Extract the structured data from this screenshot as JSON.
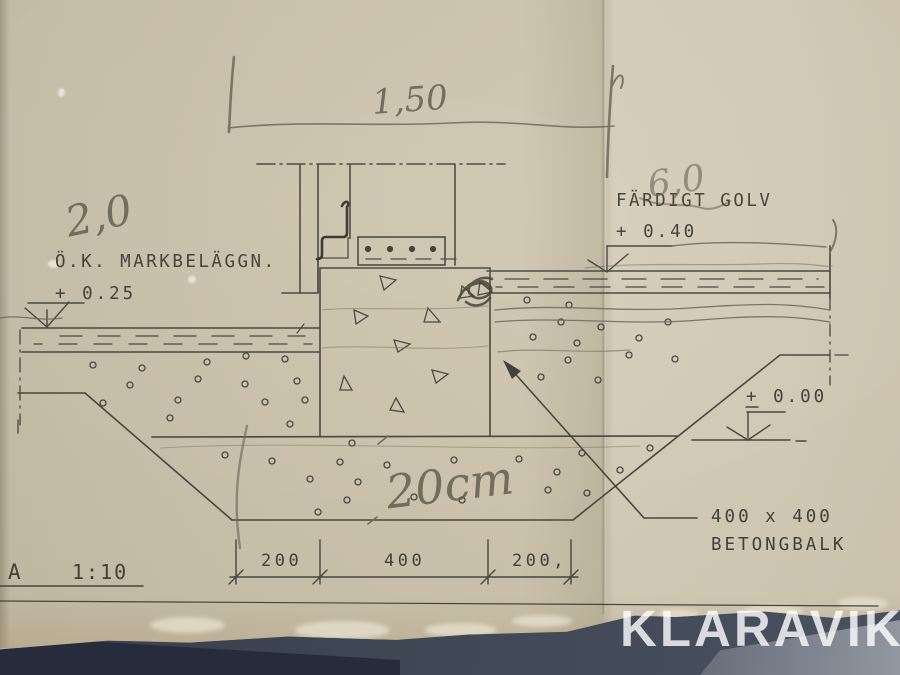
{
  "drawing": {
    "scale": {
      "detail_letter": "A",
      "ratio": "1:10"
    },
    "labels": {
      "ground_line1": "Ö.K. MARKBELÄGGN.",
      "ground_line2": "+ 0.25",
      "floor_line1": "FÄRDIGT GOLV",
      "floor_line2": "+ 0.40",
      "zero_level": "+ 0.00",
      "beam_line1": "400 x 400",
      "beam_line2": "BETONGBALK"
    },
    "dims": {
      "top": "1,50",
      "bottom": [
        "200",
        "400",
        "200,"
      ]
    },
    "handwritten": {
      "left_note": "2,0",
      "right_note": "6,0",
      "bedding_note": "20cm"
    }
  },
  "watermark": {
    "text": "KLARAVIK"
  },
  "colors": {
    "paper": "#cfc6b0",
    "ink": "#45423a",
    "pencil": "#6f6859",
    "table": "#3e4654"
  }
}
